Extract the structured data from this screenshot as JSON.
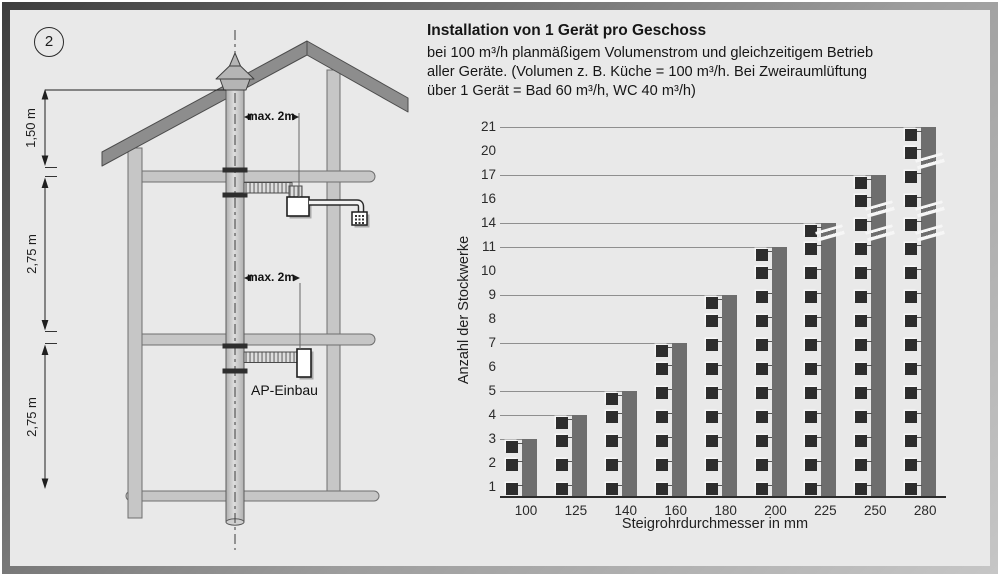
{
  "figure": {
    "number": "2"
  },
  "header": {
    "title": "Installation von 1 Gerät pro Geschoss",
    "body": [
      "bei 100 m³/h planmäßigem Volumenstrom und gleichzeitigem Betrieb",
      "aller Geräte. (Volumen z. B. Küche = 100 m³/h. Bei Zweiraumlüftung",
      "über 1 Gerät = Bad 60 m³/h, WC 40 m³/h)"
    ]
  },
  "diagram": {
    "dim_labels": [
      "1,50 m",
      "2,75 m",
      "2,75 m"
    ],
    "max_label_upper": "max. 2m",
    "max_label_lower": "max. 2m",
    "unit_label": "AP-Einbau"
  },
  "chart_data": {
    "type": "bar",
    "title": "",
    "categories": [
      100,
      125,
      140,
      160,
      180,
      200,
      225,
      250,
      280
    ],
    "values": [
      3,
      4,
      5,
      7,
      9,
      11,
      14,
      17,
      21
    ],
    "xlabel": "Steigrohrdurchmesser in mm",
    "ylabel": "Anzahl der Stockwerke",
    "y_tick_labels": [
      1,
      2,
      3,
      4,
      5,
      6,
      7,
      8,
      9,
      10,
      11,
      14,
      16,
      17,
      20,
      21
    ],
    "ylim": [
      0,
      21
    ],
    "grid": "horizontal reference line at each bar top only",
    "legend": "none",
    "device_marker": "one dark square per floor beside each bar",
    "bars_with_axis_break_marks": [
      225,
      250,
      280
    ],
    "axis_break_gaps": [
      [
        11,
        14
      ],
      [
        14,
        16
      ],
      [
        17,
        20
      ]
    ]
  },
  "colors": {
    "panel_bg": "#e9e9e9",
    "bar": "#6e6e6e",
    "device_square": "#2d2d2d",
    "roof": "#8d8d8d",
    "wall": "#c6c6c6",
    "pipe": "#cccccc",
    "text": "#1d1d1d"
  }
}
